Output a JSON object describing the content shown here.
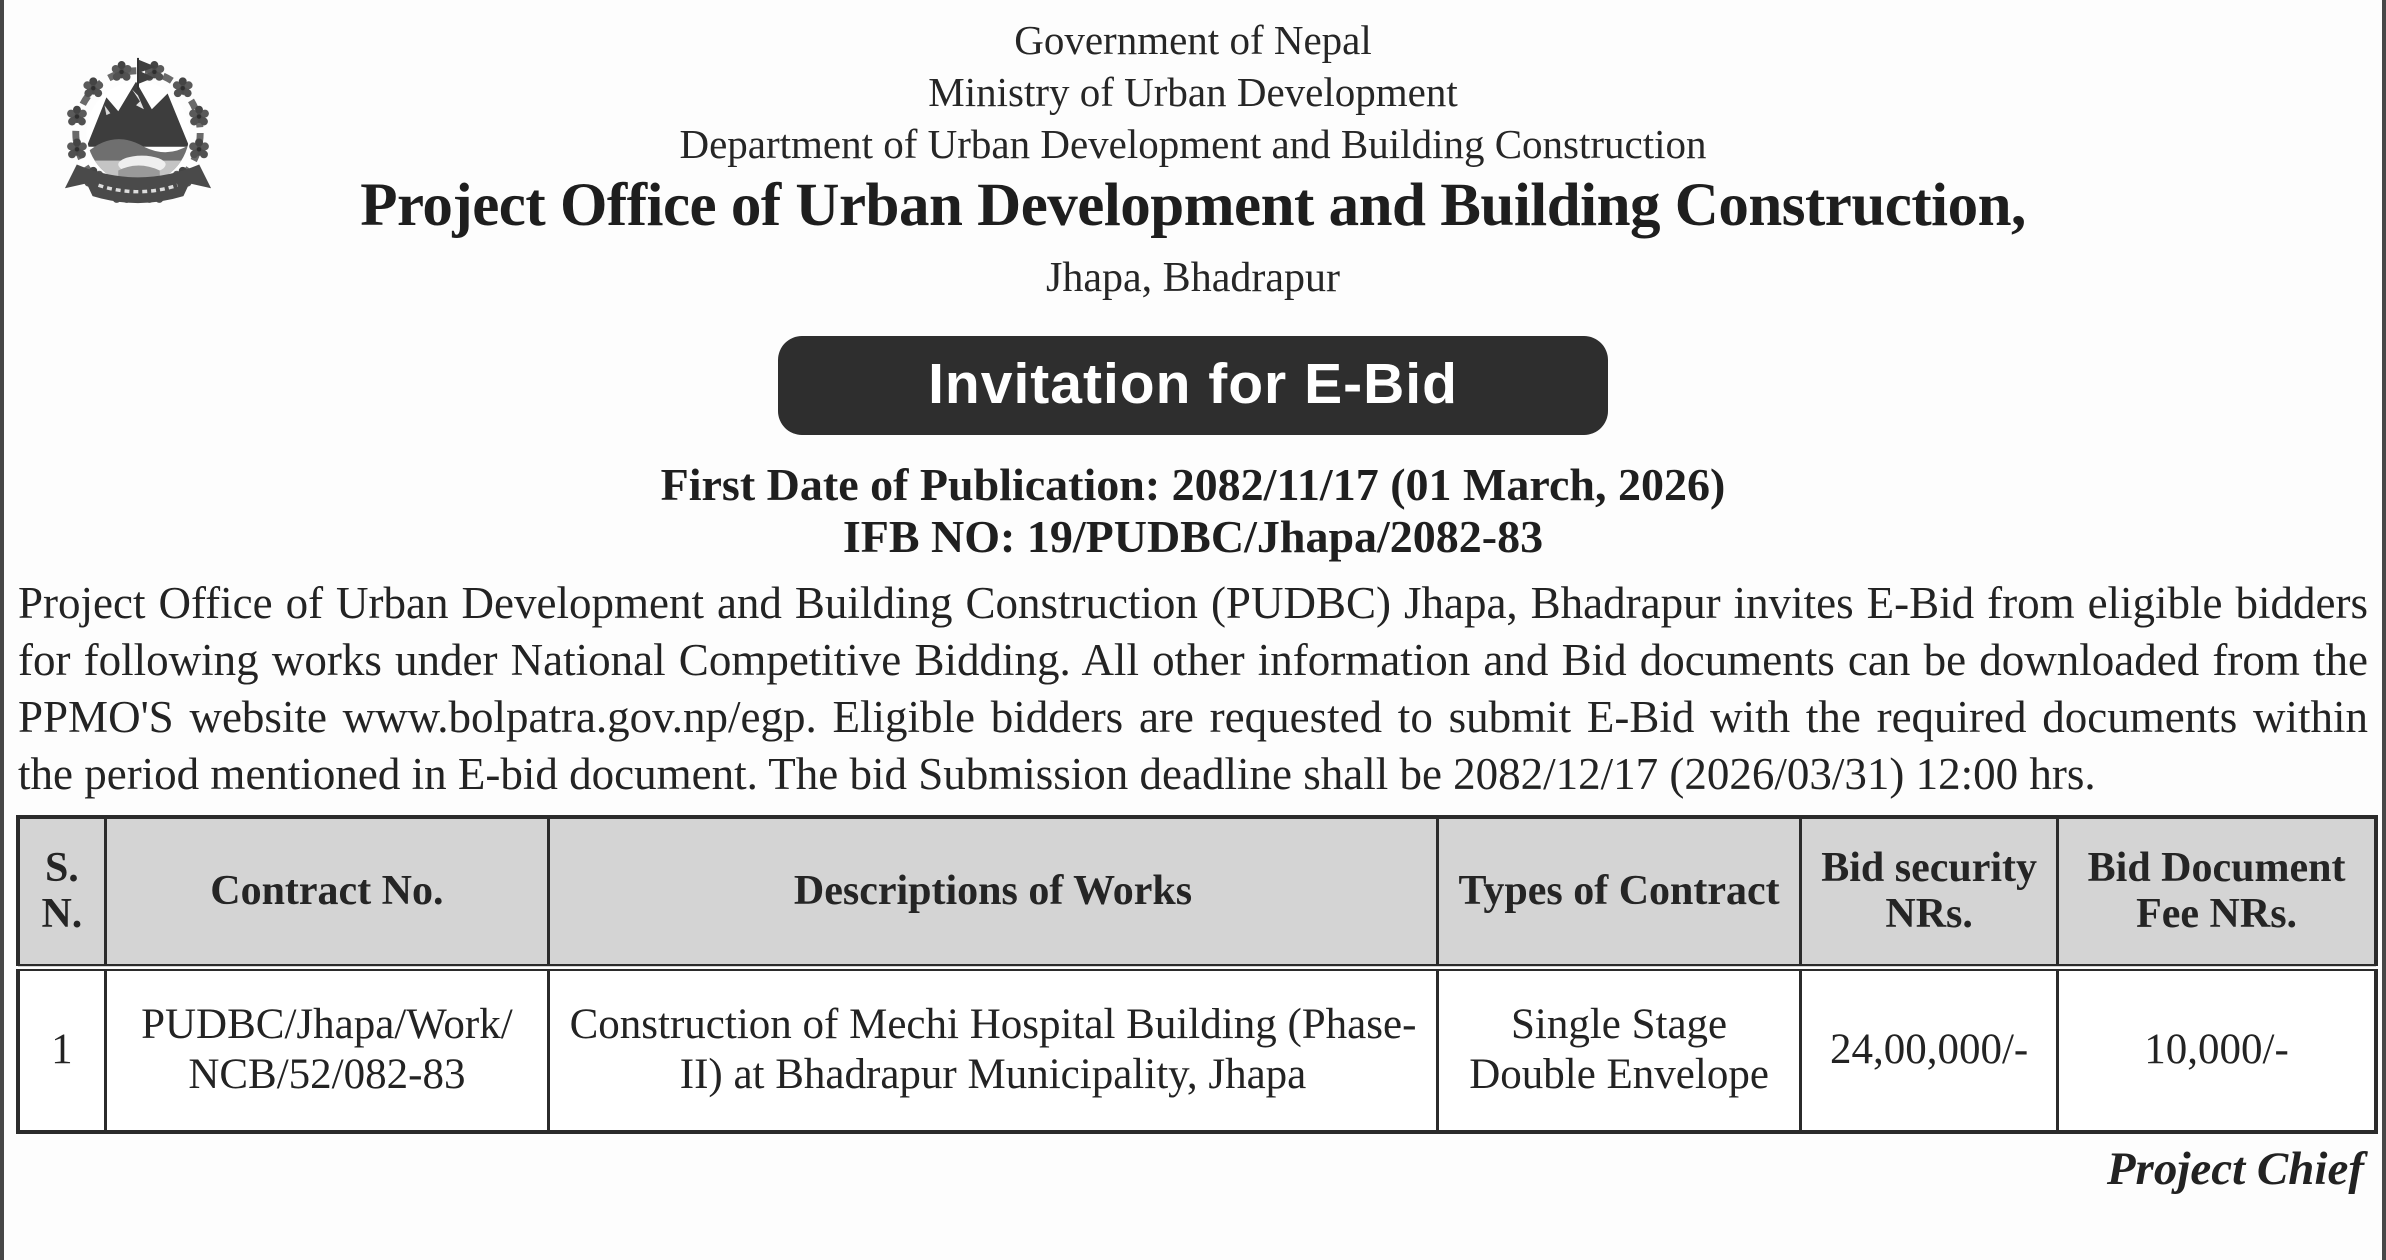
{
  "colors": {
    "banner_bg": "#2e2e2e",
    "banner_text": "#ffffff",
    "table_header_bg": "#d4d4d4",
    "table_border": "#2b2b2b",
    "text": "#242424",
    "page_edge_line": "#474747"
  },
  "icons": {
    "emblem": "nepal-government-emblem"
  },
  "doc": {
    "gov_line": "Government of Nepal",
    "ministry_line": "Ministry of Urban Development",
    "dept_line": "Department of Urban Development and Building Construction",
    "office_title": "Project Office of Urban Development and Building Construction,",
    "location": "Jhapa, Bhadrapur",
    "banner_label": "Invitation for E-Bid",
    "publication_line": "First Date of Publication: 2082/11/17 (01 March, 2026)",
    "ifb_line": "IFB NO: 19/PUDBC/Jhapa/2082-83",
    "body_paragraph": "Project Office of Urban Development and Building Construction (PUDBC) Jhapa, Bhadrapur invites E-Bid from eligible bidders for following works under National Competitive Bidding. All other information and Bid documents can be downloaded from the PPMO'S website www.bolpatra.gov.np/egp. Eligible bidders are requested to submit E-Bid with the required documents within the period mentioned in E-bid document. The bid Submission deadline shall be 2082/12/17 (2026/03/31) 12:00 hrs.",
    "signature": "Project Chief"
  },
  "table": {
    "headers": [
      "S. N.",
      "Contract No.",
      "Descriptions of Works",
      "Types of Contract",
      "Bid security NRs.",
      "Bid Document Fee NRs."
    ],
    "rows": [
      {
        "sn": "1",
        "contract_no": "PUDBC/Jhapa/Work/ NCB/52/082-83",
        "description": "Construction of Mechi Hospital Building (Phase-II) at Bhadrapur Municipality, Jhapa",
        "contract_type": "Single Stage Double Envelope",
        "bid_security_nrs": "24,00,000/-",
        "bid_document_fee_nrs": "10,000/-"
      }
    ]
  }
}
